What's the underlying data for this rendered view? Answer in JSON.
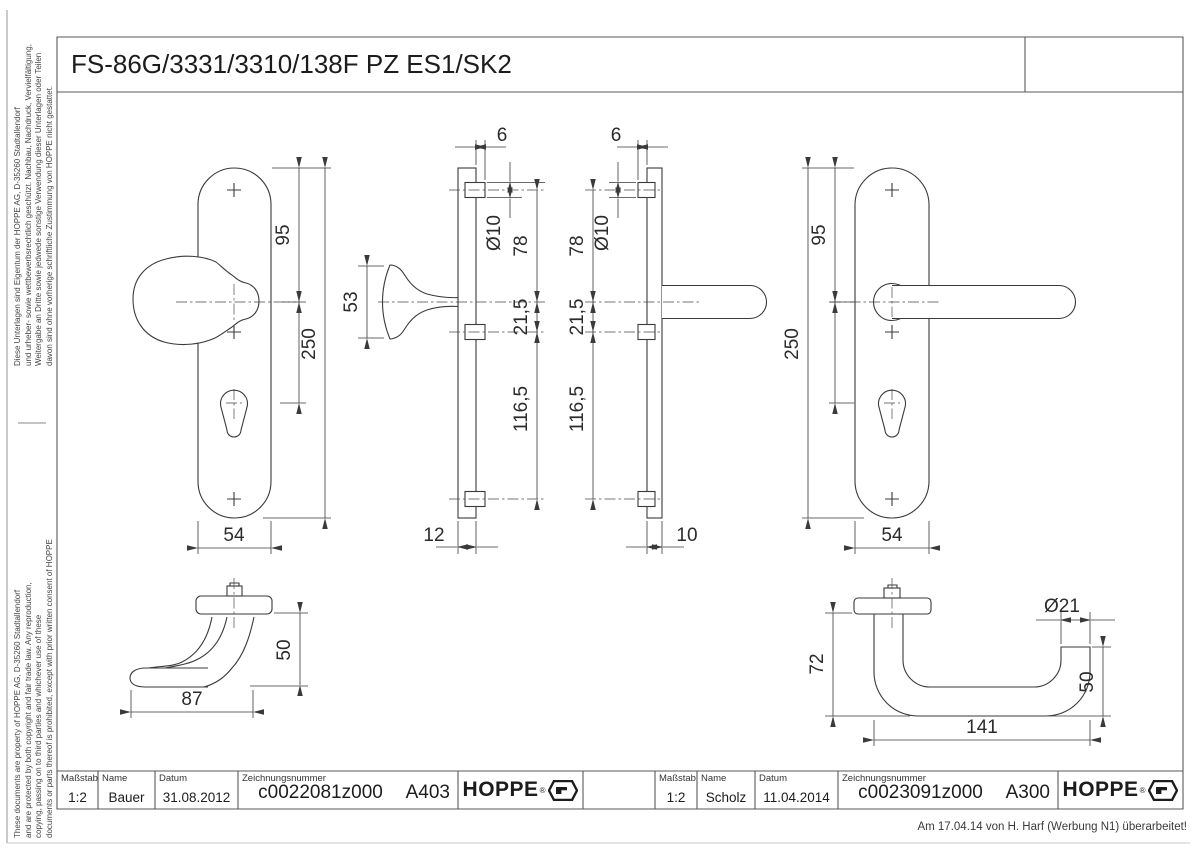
{
  "page": {
    "title": "FS-86G/3331/3310/138F PZ ES1/SK2",
    "note": "Am 17.04.14 von H. Harf (Werbung N1) überarbeitet!"
  },
  "side_notes": {
    "german": [
      "Diese Unterlagen sind Eigentum der  HOPPE AG, D-35260 Stadtallendorf",
      "und urheber- sowie wettbewerbsrechtlich geschützt. Nachbau, Nachdruck, Vervielfältigung,",
      "Weitergabe an Dritte sowie jedwede sonstige Verwendung dieser Unterlagen oder Teilen",
      "davon sind ohne vorherige schriftliche Zustimmung von HOPPE nicht gestattet."
    ],
    "english": [
      "These documents are property of HOPPE AG, D-35260 Stadtallendorf",
      "and are protected by both copyright and fair trade law. Any reproduction,",
      "copying, passing on to third parties and whichever use of these",
      "documents or parts thereof is prohibited, except with prior written consent of HOPPE"
    ]
  },
  "blocks": [
    {
      "scale_label": "Maßstab",
      "scale": "1:2",
      "name_label": "Name",
      "name": "Bauer",
      "date_label": "Datum",
      "date": "31.08.2012",
      "drawing_label": "Zeichnungsnummer",
      "drawing_no": "c0022081z000",
      "code": "A403",
      "brand": "HOPPE",
      "brand_reg": "®"
    },
    {
      "scale_label": "Maßstab",
      "scale": "1:2",
      "name_label": "Name",
      "name": "Scholz",
      "date_label": "Datum",
      "date": "11.04.2014",
      "drawing_label": "Zeichnungsnummer",
      "drawing_no": "c0023091z000",
      "code": "A300",
      "brand": "HOPPE",
      "brand_reg": "®"
    }
  ],
  "views": {
    "plate_knob_front": {
      "dim_95": "95",
      "dim_250": "250",
      "dim_54": "54"
    },
    "plate_knob_side": {
      "dim_6": "6",
      "dim_d10": "Ø10",
      "dim_78": "78",
      "dim_21_5": "21,5",
      "dim_116_5": "116,5",
      "dim_53": "53",
      "dim_12": "12"
    },
    "plate_lever_side": {
      "dim_6": "6",
      "dim_d10": "Ø10",
      "dim_78": "78",
      "dim_21_5": "21,5",
      "dim_116_5": "116,5",
      "dim_10": "10"
    },
    "plate_lever_front": {
      "dim_95": "95",
      "dim_250": "250",
      "dim_54": "54"
    },
    "knob_side": {
      "dim_50": "50",
      "dim_87": "87"
    },
    "lever_side": {
      "dim_72": "72",
      "dim_d21": "Ø21",
      "dim_50": "50",
      "dim_141": "141"
    }
  },
  "colors": {
    "line": "#3a3a3a",
    "frame": "#5a5a5a",
    "text": "#2b2b2b"
  }
}
